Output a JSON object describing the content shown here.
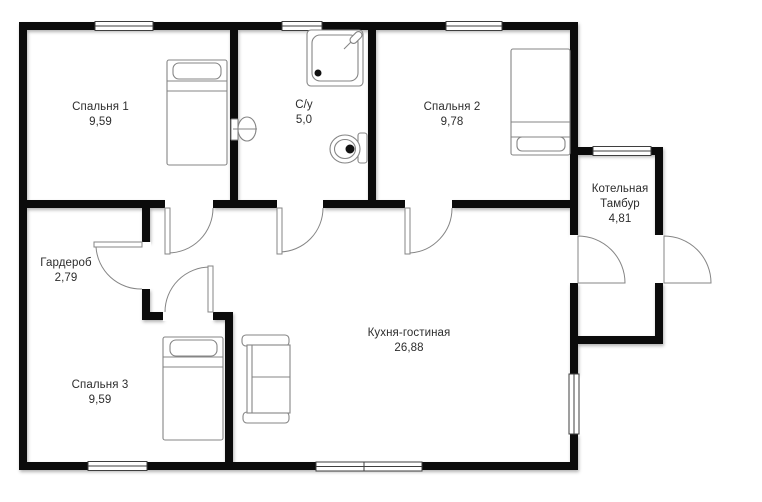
{
  "plan": {
    "title": "floor-plan",
    "rooms": [
      {
        "name": "Спальня 1",
        "area": "9,59"
      },
      {
        "name": "С/у",
        "area": "5,0"
      },
      {
        "name": "Спальня 2",
        "area": "9,78"
      },
      {
        "name": "Котельная",
        "name2": "Тамбур",
        "area": "4,81"
      },
      {
        "name": "Гардероб",
        "area": "2,79"
      },
      {
        "name": "Спальня 3",
        "area": "9,59"
      },
      {
        "name": "Кухня-гостиная",
        "area": "26,88"
      }
    ],
    "icons": [
      "bed-icon",
      "sofa-icon",
      "shower-icon",
      "toilet-icon",
      "wall-lamp-icon",
      "door-swing-icon",
      "window-icon"
    ],
    "colors": {
      "wall": "#0b0b0b",
      "furniture_outline": "#858585",
      "window_frame": "#3f3f3f",
      "text": "#2d2d2d",
      "background": "#ffffff"
    }
  }
}
